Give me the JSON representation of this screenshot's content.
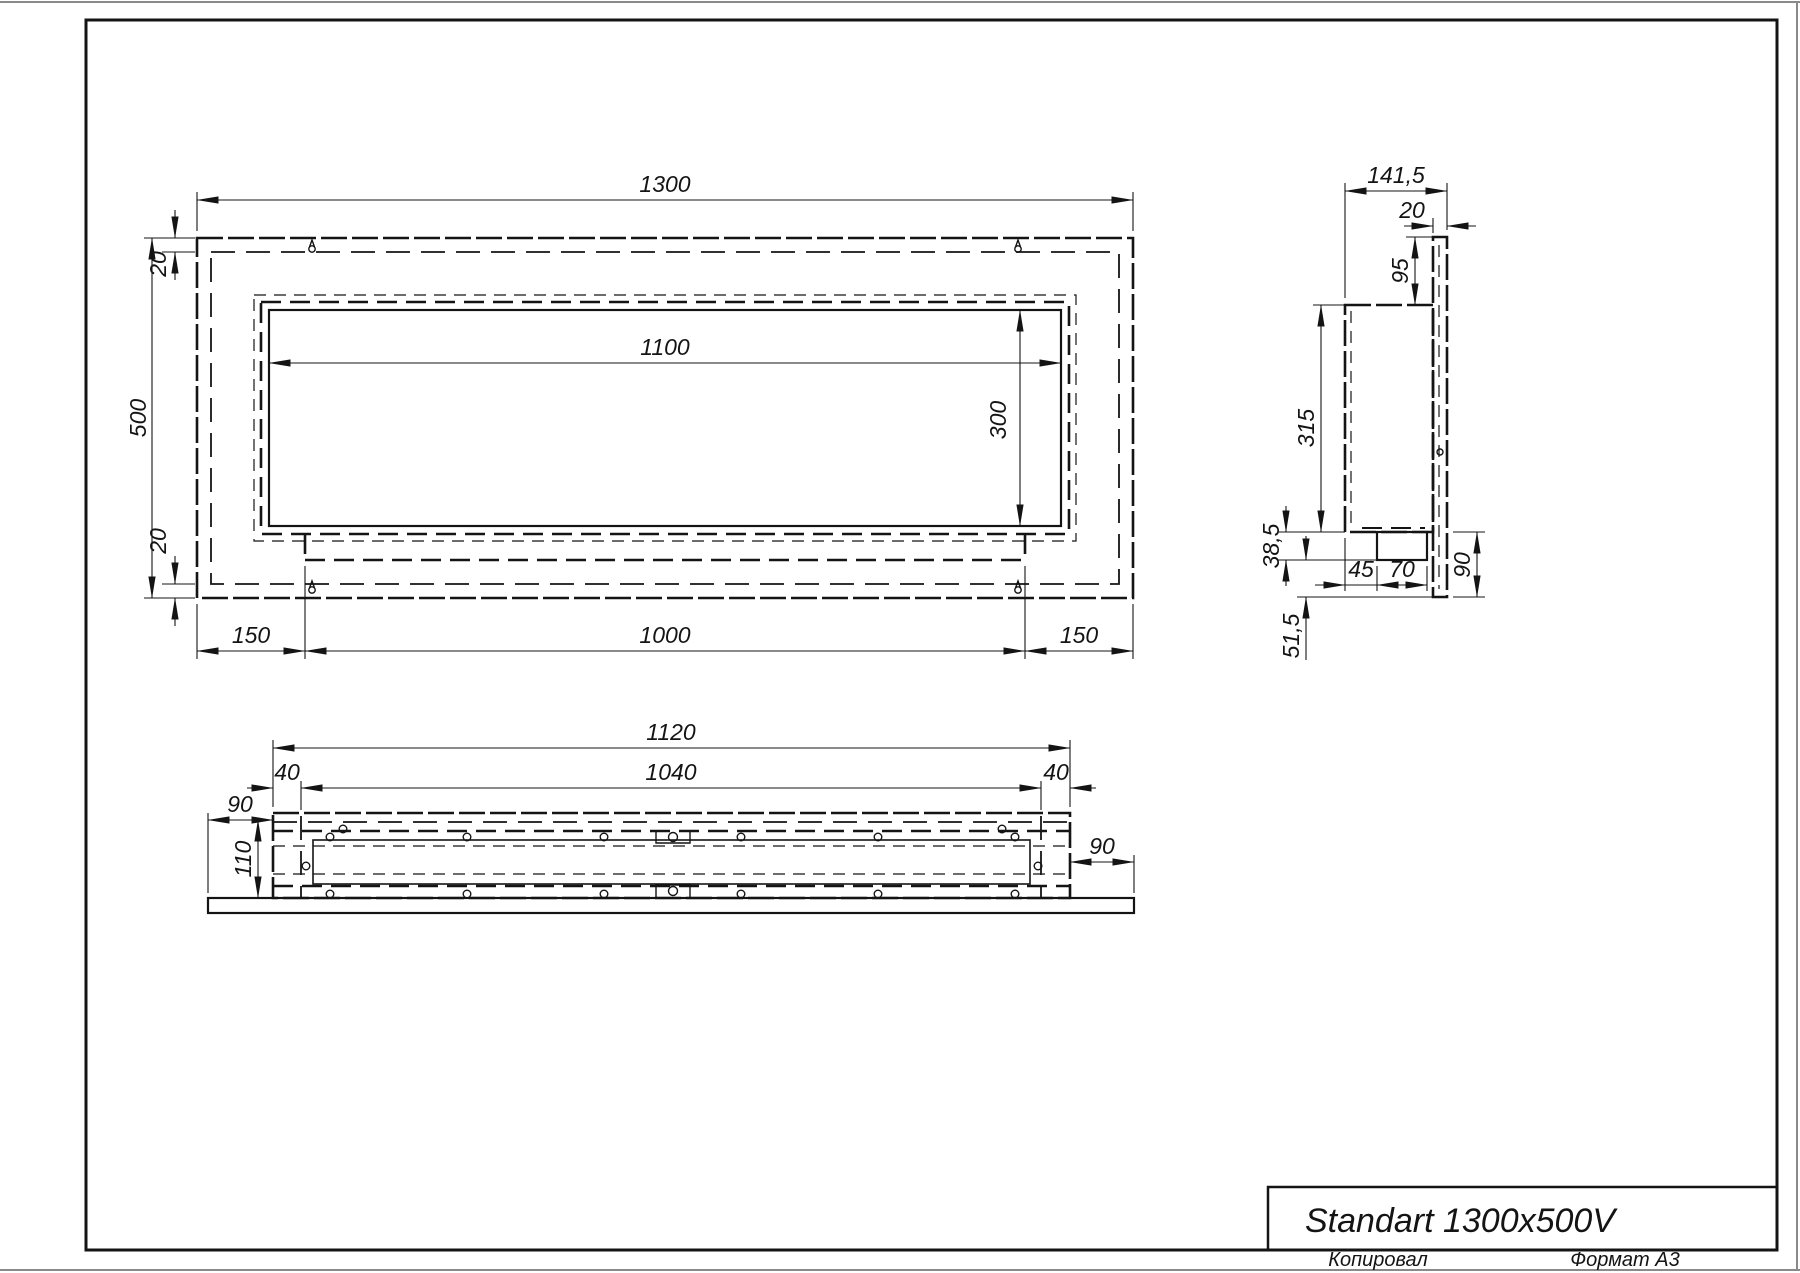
{
  "title_block": {
    "title": "Standart 1300x500V"
  },
  "footer": {
    "copied_label": "Копировал",
    "format_label": "Формат А3"
  },
  "front_view": {
    "dims": {
      "overall_width": "1300",
      "overall_height": "500",
      "top_inset": "20",
      "bottom_inset": "20",
      "opening_width": "1100",
      "opening_height": "300",
      "left_offset": "150",
      "center_width": "1000",
      "right_offset": "150"
    }
  },
  "side_view": {
    "dims": {
      "overall_depth": "141,5",
      "panel_thickness": "20",
      "top_offset": "95",
      "body_height": "315",
      "tray_drop": "38,5",
      "tray_offset": "45",
      "tray_width": "70",
      "lower_height": "90",
      "bottom_drop": "51,5"
    }
  },
  "bottom_view": {
    "dims": {
      "body_width": "1120",
      "inner_width": "1040",
      "left_inset": "40",
      "right_inset": "40",
      "left_overhang": "90",
      "body_depth": "110",
      "right_overhang": "90"
    }
  }
}
